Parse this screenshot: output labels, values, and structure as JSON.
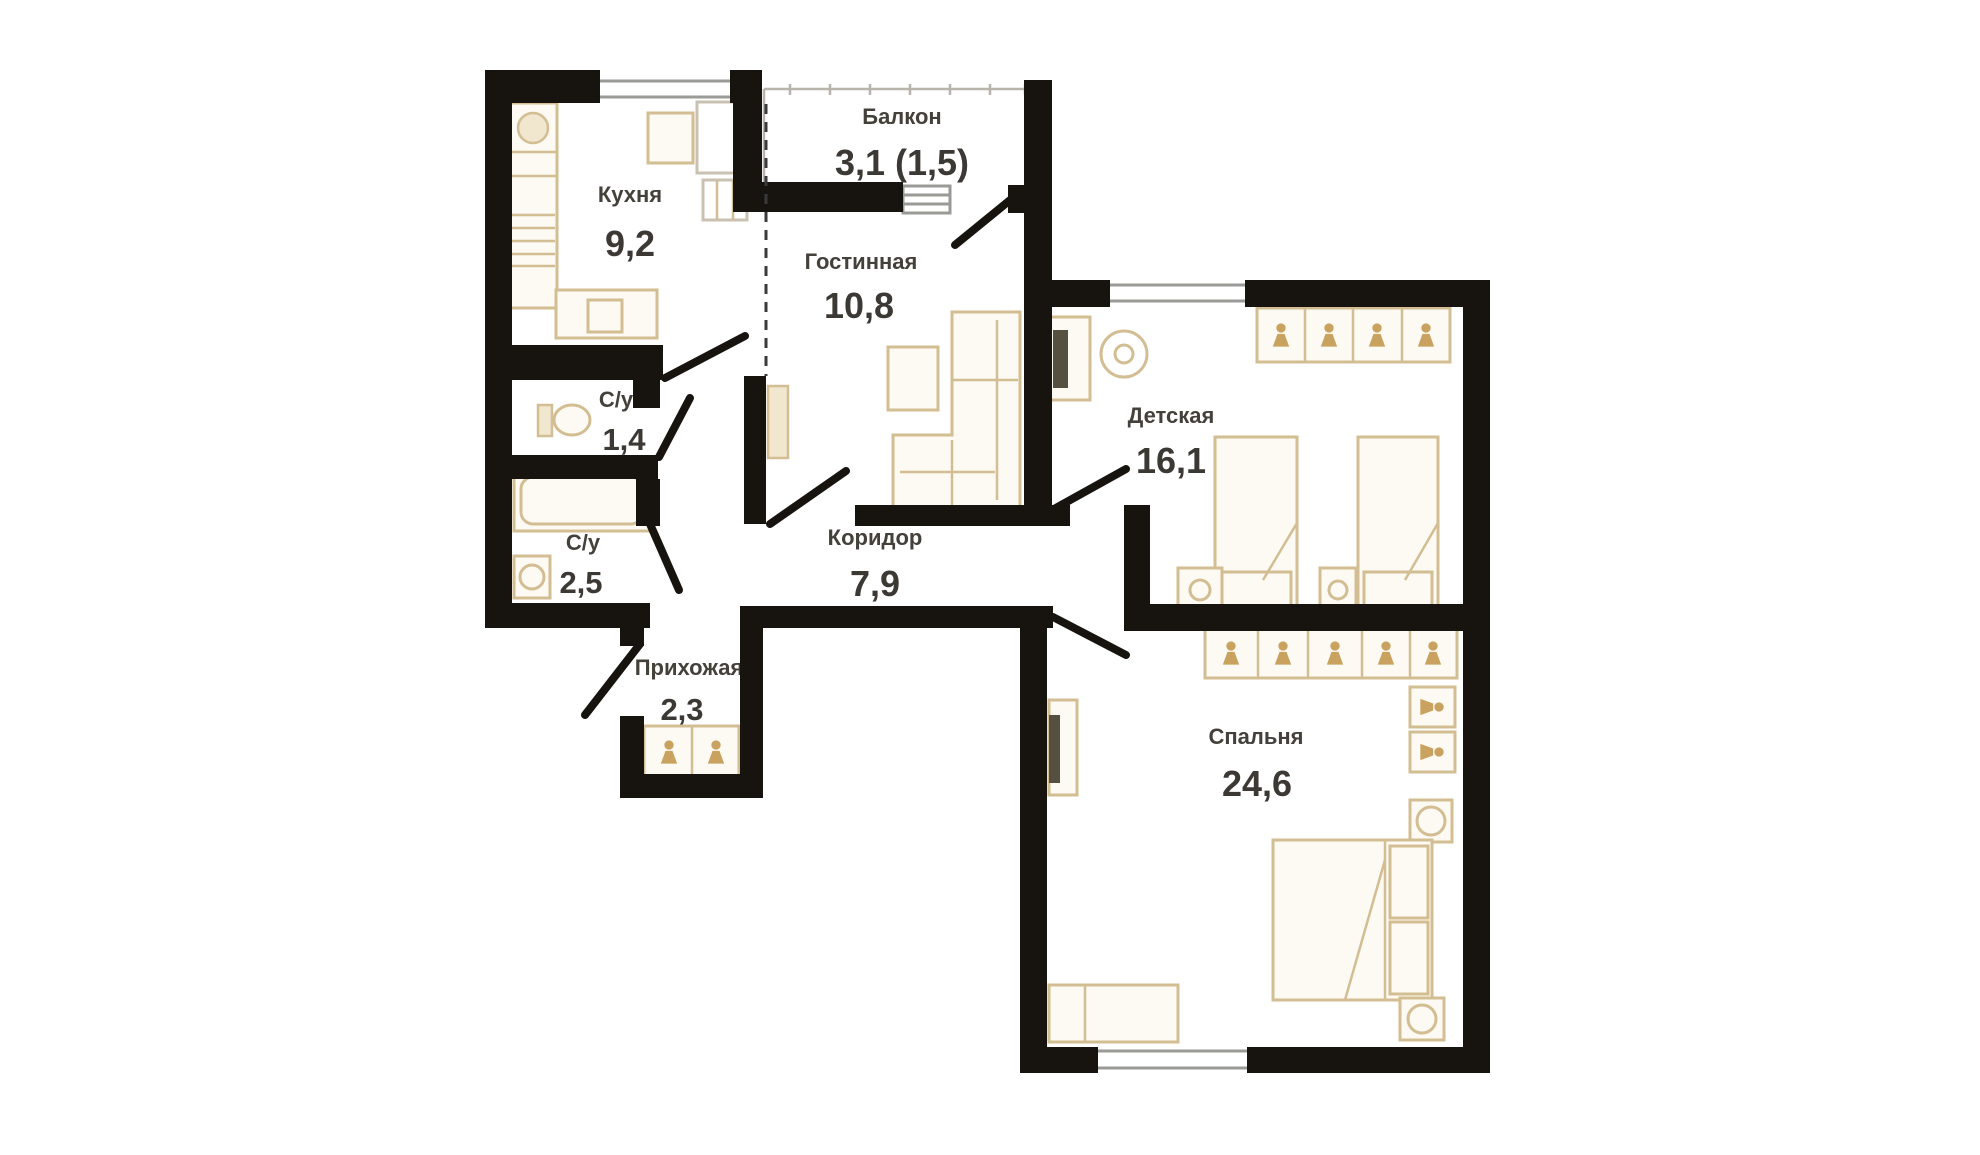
{
  "title": "Apartment floor plan",
  "colors": {
    "wall": "#17130e",
    "furniture_outline": "#d3bd92",
    "accent_tan": "#c8a25e",
    "window_line": "#9a9a96",
    "label_text": "#44403a"
  },
  "rooms": {
    "kitchen": {
      "label": "Кухня",
      "area": "9,2"
    },
    "balcony": {
      "label": "Балкон",
      "area": "3,1 (1,5)"
    },
    "living_room": {
      "label": "Гостинная",
      "area": "10,8"
    },
    "bathroom_small": {
      "label": "С/у",
      "area": "1,4"
    },
    "bathroom_large": {
      "label": "С/у",
      "area": "2,5"
    },
    "entry_hall": {
      "label": "Прихожая",
      "area": "2,3"
    },
    "corridor": {
      "label": "Коридор",
      "area": "7,9"
    },
    "kids_room": {
      "label": "Детская",
      "area": "16,1"
    },
    "bedroom": {
      "label": "Спальня",
      "area": "24,6"
    }
  },
  "icons": {
    "wardrobe": "hanger-icon",
    "sink": "sink-icon",
    "toilet": "toilet-icon",
    "bathtub": "bathtub-icon",
    "washer": "washing-machine-icon"
  }
}
